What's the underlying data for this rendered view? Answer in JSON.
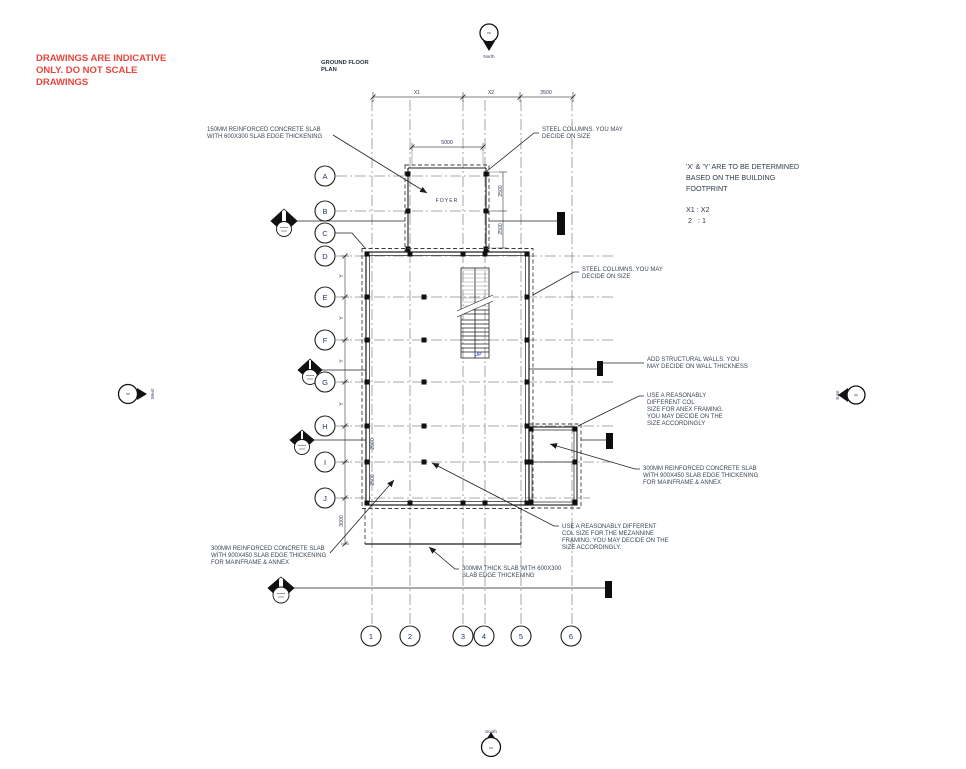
{
  "disclaimer": {
    "lines": [
      "DRAWINGS ARE INDICATIVE",
      "ONLY. DO NOT SCALE",
      "DRAWINGS"
    ],
    "color": "#e8463c"
  },
  "title": {
    "lines": [
      "GROUND FLOOR",
      "PLAN"
    ]
  },
  "compass": {
    "north": "North",
    "south": "South",
    "east": "East",
    "west": "West"
  },
  "grid": {
    "rows": [
      "A",
      "B",
      "C",
      "D",
      "E",
      "F",
      "G",
      "H",
      "I",
      "J"
    ],
    "cols": [
      "1",
      "2",
      "3",
      "4",
      "5",
      "6"
    ]
  },
  "dimensions": {
    "top": {
      "x1": "X1",
      "x2": "X2",
      "right": "3500"
    },
    "foyer": {
      "width": "5000",
      "upper": "2500",
      "lower": "2500"
    },
    "left": {
      "y1": "Y",
      "y2": "Y",
      "y3": "Y",
      "y4": "Y",
      "h_i": "2500",
      "i_j": "2500",
      "j_edge": "3000"
    }
  },
  "labels": {
    "foyer": "FOYER",
    "up": "UP"
  },
  "footprint_note": {
    "lines": [
      "'X' & 'Y' ARE TO BE DETERMINED",
      "BASED ON THE BUILDING",
      "FOOTPRINT"
    ],
    "ratio": [
      "X1 : X2",
      "2   : 1"
    ]
  },
  "annotations": {
    "slab150": [
      "150MM REINFORCED CONCRETE SLAB",
      "WITH 600X300 SLAB EDGE THICKENING"
    ],
    "steel_cols_top": [
      "STEEL COLUMNS. YOU MAY",
      "DECIDE ON SIZE"
    ],
    "steel_cols_mid": [
      "STEEL COLUMNS. YOU MAY",
      "DECIDE ON SIZE"
    ],
    "structural_walls": [
      "ADD STRUCTURAL WALLS. YOU",
      "MAY DECIDE ON WALL THICKNESS"
    ],
    "anex_columns": [
      "USE A REASONABLY",
      "DIFFERENT COL",
      "SIZE FOR ANEX FRAMING.",
      "YOU MAY DECIDE ON THE",
      "SIZE ACCORDINGLY"
    ],
    "slab300_right": [
      "300MM REINFORCED CONCRETE SLAB",
      "WITH 900X450 SLAB EDGE THICKENING",
      "FOR MAINFRAME & ANNEX"
    ],
    "mezzanine_columns": [
      "USE A REASONABLY DIFFERENT",
      "COL SIZE FOR THE MEZANNINE",
      "FRAMING. YOU MAY DECIDE ON THE",
      "SIZE ACCORDINGLY."
    ],
    "slab_bottom": [
      "300MM THICK SLAB WITH 600X300",
      "SLAB EDGE THICKENING"
    ],
    "slab300_left": [
      "300MM REINFORCED CONCRETE SLAB",
      "WITH 900X450 SLAB EDGE THICKENING",
      "FOR MAINFRAME & ANNEX"
    ]
  },
  "colors": {
    "red_note": "#e8463c",
    "annotation_text": "#3b4754",
    "dimension_text": "#33415c",
    "linework": "#1c1c1c",
    "up_label": "#4a5fc1"
  }
}
